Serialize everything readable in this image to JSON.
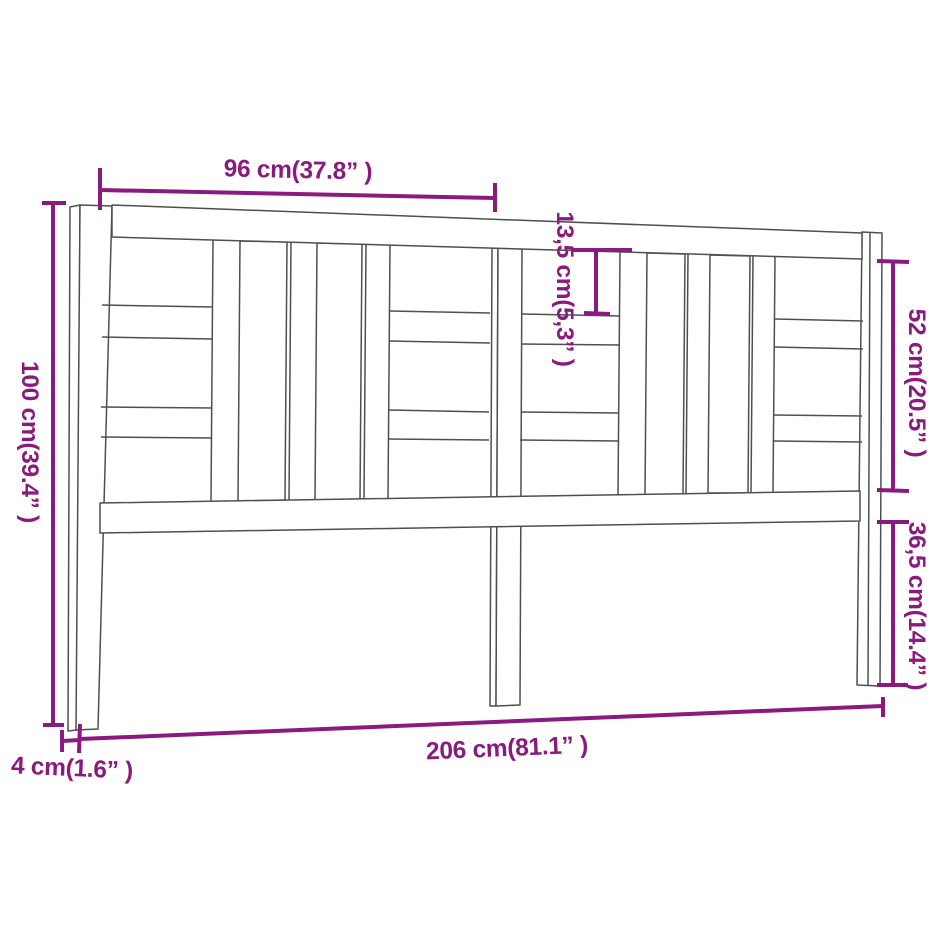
{
  "meta": {
    "subject": "Bed headboard technical line drawing with dimension annotations",
    "accent_color": "#8a1a7d",
    "line_color": "#4f4f4f",
    "background_color": "#ffffff"
  },
  "dimensions": {
    "top_section_width": "96 cm(37.8” )",
    "overall_height": "100 cm(39.4” )",
    "slat_board_height": "13,5 cm(5,3” )",
    "panel_section_height": "52 cm(20.5” )",
    "leg_section_height": "36,5 cm(14.4” )",
    "overall_width": "206 cm(81.1” )",
    "frame_thickness": "4 cm(1.6” )"
  }
}
